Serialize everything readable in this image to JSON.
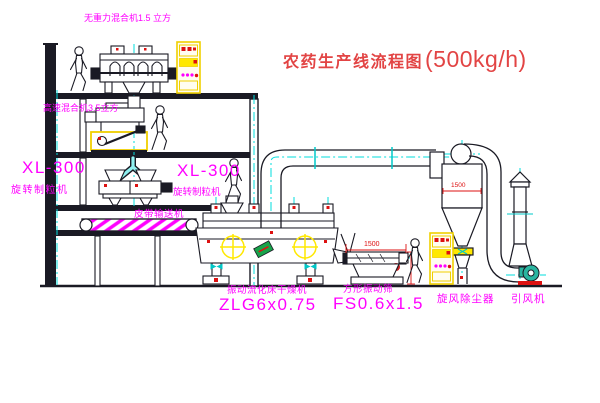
{
  "title": {
    "text_cn": "农药生产线流程图",
    "capacity": "(500kg/h)"
  },
  "labels": {
    "gravity_free_mixer": "无重力混合机1.5 立方",
    "high_speed_mixer": "高速混合机3.5立方",
    "granulator_left": {
      "model": "XL-300",
      "name": "旋转制粒机"
    },
    "granulator_right": {
      "model": "XL-300",
      "name": "旋转制粒机"
    },
    "belt_conveyor": "皮带输送机",
    "fluid_bed_dryer": {
      "name": "振动流化床干燥机",
      "model": "ZLG6x0.75"
    },
    "square_sieve": {
      "name": "方形振动筛",
      "model": "FS0.6x1.5"
    },
    "cyclone": "旋风除尘器",
    "induced_draft_fan": "引风机"
  },
  "dimensions": {
    "sieve_length": "1500",
    "cyclone_body": "1500"
  },
  "colors": {
    "label_magenta": "#ff00ff",
    "title_red": "#e24444",
    "line_dark": "#1a1a24",
    "centerline_cyan": "#00dede",
    "equipment_yellow": "#ffe800",
    "accent_red": "#dd1111",
    "accent_green": "#18a34a",
    "fan_teal": "#2ab5a0"
  }
}
